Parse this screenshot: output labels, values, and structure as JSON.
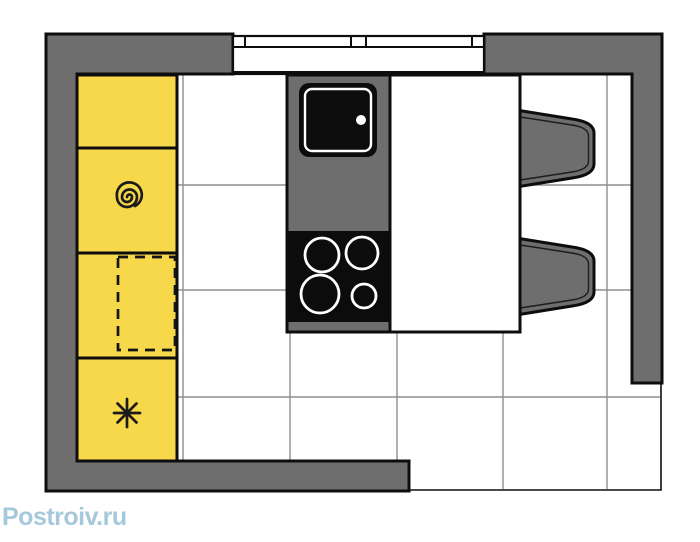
{
  "watermark": {
    "text": "Postroiv.ru"
  },
  "colors": {
    "background": "#ffffff",
    "wall": "#6e6e6e",
    "outline": "#0d0d0d",
    "cabinet": "#f6d84a",
    "tile_line": "#8f8f8f",
    "appliance_black": "#0c0c0c",
    "watermark_blue": "#a5c9db"
  },
  "plan": {
    "type": "kitchen-floor-plan-top-view",
    "walls": {
      "top": "full with window gap",
      "left": "full",
      "right": "partial, ends before bottom corner",
      "bottom": "partial, ends before right corner",
      "opening": "bottom-right corner shown with thin boundary lines"
    },
    "window": {
      "wall": "top",
      "pane_sections": 3
    },
    "cabinet_run": {
      "side": "left",
      "units": [
        {
          "index": 1,
          "symbol": "blank"
        },
        {
          "index": 2,
          "symbol": "spiral"
        },
        {
          "index": 3,
          "symbol": "dashed-rectangle"
        },
        {
          "index": 4,
          "symbol": "eight-ray-asterisk"
        }
      ],
      "fill": "yellow"
    },
    "island": {
      "attached_to": "top wall",
      "sink": {
        "basins": 1,
        "drain_dot": true
      },
      "cooktop": {
        "burners": 4,
        "burner_sizes": [
          "large",
          "large",
          "largest",
          "small"
        ]
      },
      "table_extension": "white right half"
    },
    "chairs": {
      "count": 2,
      "side": "right of island",
      "facing": "left"
    },
    "floor": {
      "pattern": "square tile grid",
      "tile_columns": 6,
      "tile_rows": 4
    }
  }
}
